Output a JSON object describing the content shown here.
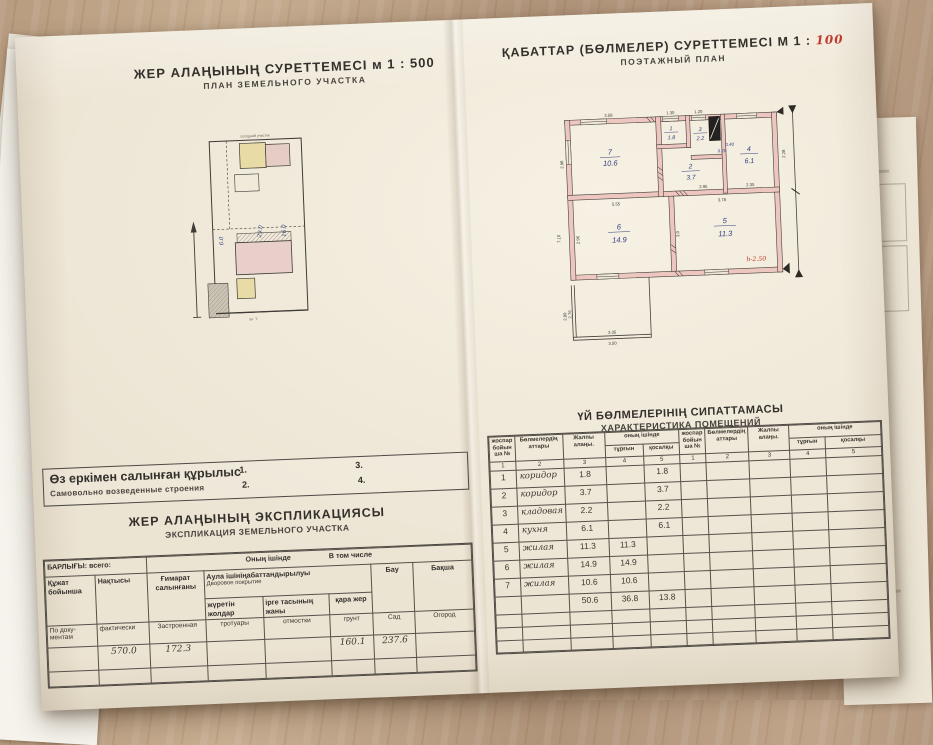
{
  "left_page": {
    "title": "ЖЕР  АЛАҢЫНЫҢ  СУРЕТТЕМЕСІ",
    "scale": "м 1 : 500",
    "subtitle": "ПЛАН  ЗЕМЕЛЬНОГО  УЧАСТКА",
    "plot_plan": {
      "top_label": "соседний участок",
      "street_label": "ул. Т.",
      "hw1": "6.0",
      "hw2": "29.0",
      "hw3": "16.0"
    },
    "selfbuilt": {
      "kk": "Өз еркімен салынған құрылыс",
      "ru": "Самовольно  возведенные строения",
      "n1": "1.",
      "n2": "2.",
      "n3": "3.",
      "n4": "4."
    },
    "expl": {
      "title_kk": "ЖЕР АЛАҢЫНЫҢ ЭКСПЛИКАЦИЯСЫ",
      "title_ru": "ЭКСПЛИКАЦИЯ ЗЕМЕЛЬНОГО УЧАСТКА",
      "h_total": "БАРЛЫҒЫ: всего:",
      "h_incl_kk": "Оның ішінде",
      "h_incl_ru": "В том числе",
      "c1_kk": "Құжат бойынша",
      "c2_kk": "Нақтысы",
      "c3_kk": "Ғимарат салынғаны",
      "c456_kk": "Аула ішініңабаттандырылуы",
      "c456_ru": "Дворовое покрытие",
      "c4_kk": "жүретін жолдар",
      "c5_kk": "ірге тасының жаны",
      "c6_kk": "қара жер",
      "c7_kk": "Бау",
      "c8_kk": "Бақша",
      "c1_ru": "По доку- ментам",
      "c2_ru": "фактически",
      "c3_ru": "Застроенная",
      "c4_ru": "тротуары",
      "c5_ru": "отмостки",
      "c6_ru": "грунт",
      "c7_ru": "Сад",
      "c8_ru": "Огород",
      "v_fact": "570.0",
      "v_built": "172.3",
      "v_ground": "160.1",
      "v_garden": "237.6"
    }
  },
  "right_page": {
    "title": "ҚАБАТТАР (БӨЛМЕЛЕР) СУРЕТТЕМЕСІ",
    "scale_prefix": "М 1 :",
    "scale_value": "100",
    "subtitle": "ПОЭТАЖНЫЙ  ПЛАН",
    "plan": {
      "rooms": {
        "r1": {
          "no": "1",
          "area": "1.8"
        },
        "r2": {
          "no": "2",
          "area": "3.7"
        },
        "r3": {
          "no": "3",
          "area": "2.2"
        },
        "r4": {
          "no": "4",
          "area": "6.1"
        },
        "r5": {
          "no": "5",
          "area": "11.3"
        },
        "r6": {
          "no": "6",
          "area": "14.9"
        },
        "r7": {
          "no": "7",
          "area": "10.6"
        }
      },
      "dims": {
        "d358": "3.58",
        "d130": "1.30",
        "d120": "1.20",
        "d298": "2.98",
        "d295": "2.95",
        "d235": "2.35",
        "d228": "2.28",
        "d555": "5.55",
        "d378": "3.78",
        "d296": "2.96",
        "d30": "3.0",
        "d710": "7.10",
        "d040": "0.40",
        "d020": "0.20",
        "d335": "3.35",
        "d350": "3.50",
        "d289": "2.89",
        "d276": "2.76"
      },
      "height_note": "h-2.50"
    },
    "table": {
      "title_kk": "ҮЙ БӨЛМЕЛЕРІНІҢ СИПАТТАМАСЫ",
      "title_ru": "ХАРАКТЕРИСТИКА ПОМЕЩЕНИЙ",
      "col_no": "жоспар бойын ша №",
      "col_name": "Бөлмелердің аттары",
      "col_total": "Жалпы алаңы.",
      "col_incl": "оның ішінде",
      "col_living": "тұрғын",
      "col_aux": "қосалқы",
      "nums": [
        "1",
        "2",
        "3",
        "4",
        "5"
      ],
      "rows": [
        {
          "no": "1",
          "name": "коридор",
          "total": "1.8",
          "living": "",
          "aux": "1.8"
        },
        {
          "no": "2",
          "name": "коридор",
          "total": "3.7",
          "living": "",
          "aux": "3.7"
        },
        {
          "no": "3",
          "name": "кладовая",
          "total": "2.2",
          "living": "",
          "aux": "2.2"
        },
        {
          "no": "4",
          "name": "кухня",
          "total": "6.1",
          "living": "",
          "aux": "6.1"
        },
        {
          "no": "5",
          "name": "жилая",
          "total": "11.3",
          "living": "11.3",
          "aux": ""
        },
        {
          "no": "6",
          "name": "жилая",
          "total": "14.9",
          "living": "14.9",
          "aux": ""
        },
        {
          "no": "7",
          "name": "жилая",
          "total": "10.6",
          "living": "10.6",
          "aux": ""
        }
      ],
      "totals": {
        "total": "50.6",
        "living": "36.8",
        "aux": "13.8"
      }
    }
  }
}
